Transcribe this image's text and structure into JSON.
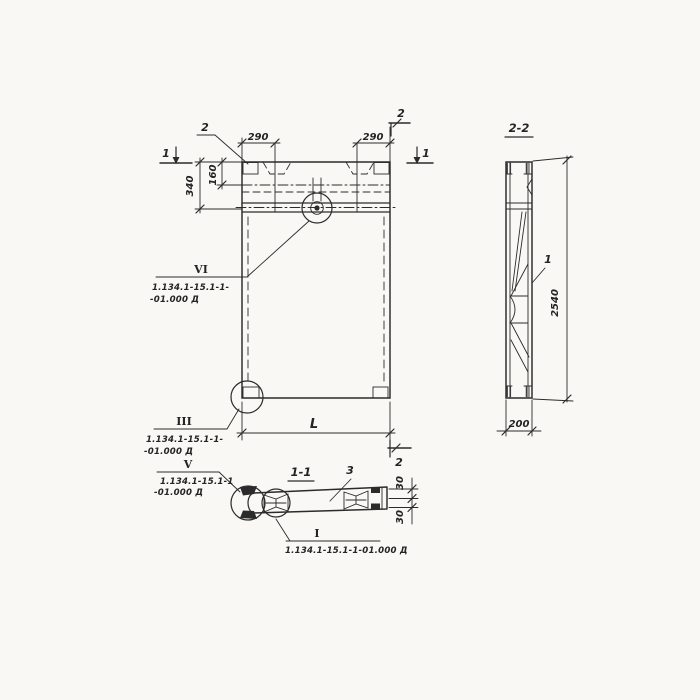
{
  "colors": {
    "ink": "#2b2b2b",
    "paper": "#f9f8f5"
  },
  "front_view": {
    "embed_callout": "2",
    "dim_290_left": "290",
    "dim_290_right": "290",
    "dim_340": "340",
    "dim_160": "160",
    "dim_length": "L",
    "cut_marker_1_left": "1",
    "cut_marker_1_right": "1",
    "cut_marker_2_top": "2",
    "cut_marker_2_bottom": "2",
    "detail_vi": {
      "label": "VI",
      "line1": "1.134.1-15.1-1-",
      "line2": "-01.000 Д"
    },
    "detail_iii": {
      "label": "III",
      "line1": "1.134.1-15.1-1-",
      "line2": "-01.000 Д"
    }
  },
  "section_2_2": {
    "title": "2-2",
    "part_1": "1",
    "dim_2540": "2540",
    "dim_200": "200"
  },
  "section_1_1": {
    "title": "1-1",
    "part_3": "3",
    "dim_30_top": "30",
    "dim_30_bottom": "30",
    "detail_v": {
      "label": "V",
      "line1": "1.134.1-15.1-1",
      "line2": "-01.000 Д"
    },
    "detail_i": {
      "label": "I",
      "text": "1.134.1-15.1-1-01.000 Д"
    }
  }
}
